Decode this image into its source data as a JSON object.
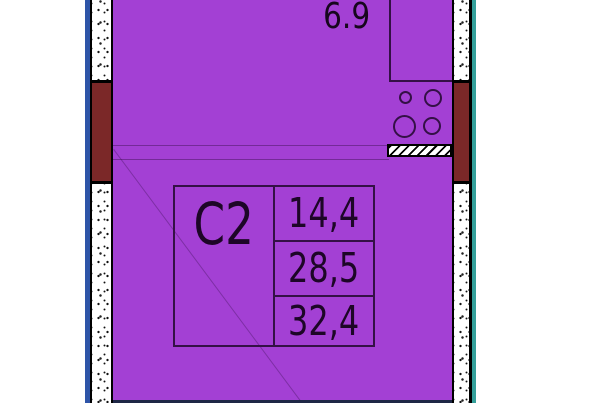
{
  "floorplan": {
    "unit_type": "С2",
    "areas": [
      "14,4",
      "28,5",
      "32,4"
    ],
    "top_room_area": "6.9",
    "colors": {
      "flat_fill": "#A340D4",
      "line": "#341046",
      "text": "#1D0627",
      "window": "#7B2828",
      "edge_left": "#2E55A8",
      "edge_right": "#35A09B",
      "edge_bottom": "#1E2746"
    },
    "icons": [
      "stove-icon",
      "vent-hatch-icon"
    ]
  }
}
